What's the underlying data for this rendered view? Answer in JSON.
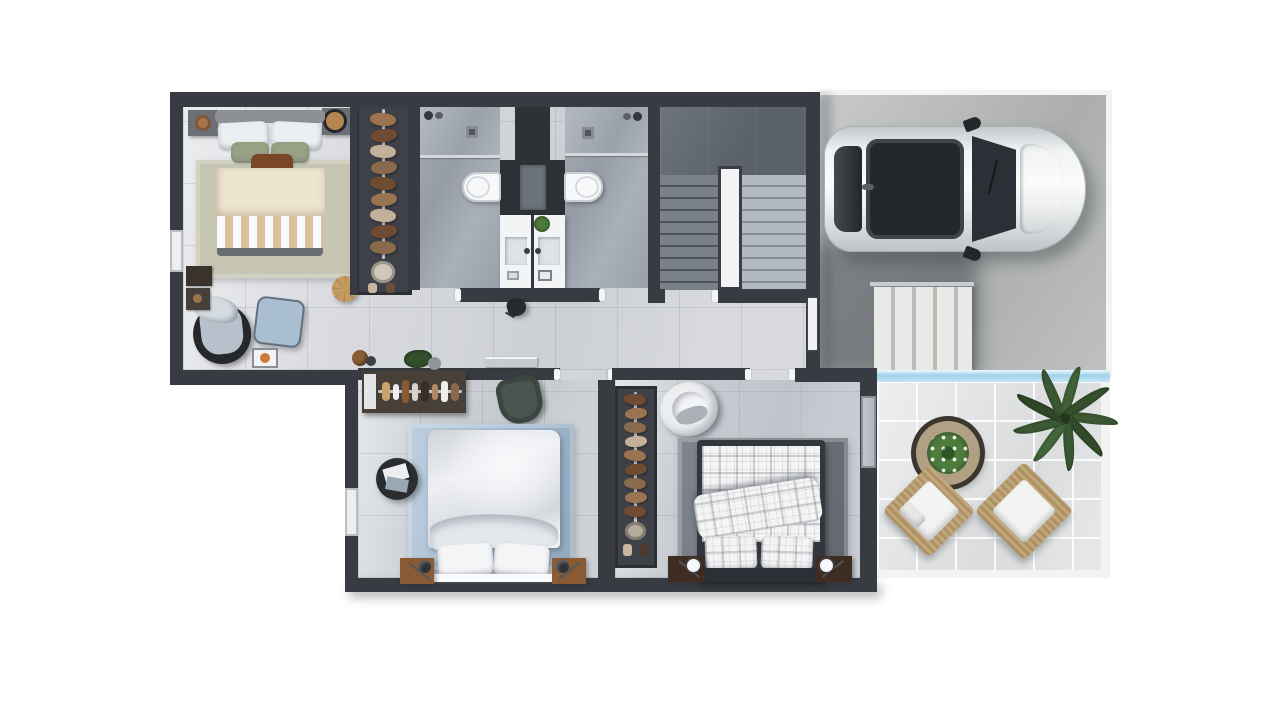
{
  "scene": {
    "type": "3d-floor-plan-render-top-down",
    "background": "#ffffff",
    "areas": [
      {
        "name": "bedroom-top-left",
        "objects": [
          "double-bed",
          "beige-duvet",
          "striped-runner",
          "sage-pillows",
          "rust-accent-pillow",
          "headboard",
          "nightstand-left",
          "nightstand-right",
          "sage-area-rug",
          "armchair",
          "blue-ottoman",
          "jute-pouf",
          "decor-tray",
          "wall-decor-boxes",
          "window"
        ]
      },
      {
        "name": "walk-in-closet-top",
        "objects": [
          "clothes-rail",
          "hanging-clothes",
          "shoes",
          "laundry-basket",
          "potted-plant"
        ]
      },
      {
        "name": "bathroom-left",
        "objects": [
          "walk-in-shower",
          "shower-drain",
          "shower-fixtures",
          "wall-hung-toilet",
          "vanity-sink",
          "faucet",
          "vanity-plant"
        ]
      },
      {
        "name": "bathroom-right",
        "objects": [
          "walk-in-shower",
          "shower-drain",
          "shower-fixtures",
          "wall-hung-toilet",
          "vanity-sink",
          "faucet"
        ]
      },
      {
        "name": "staircase",
        "objects": [
          "upper-landing",
          "down-flight",
          "up-flight",
          "white-center-wall"
        ]
      },
      {
        "name": "hallway",
        "objects": [
          "stool",
          "clay-pot",
          "potted-plant",
          "front-door"
        ]
      },
      {
        "name": "bedroom-bottom-left",
        "objects": [
          "double-bed-white",
          "white-pillows",
          "blue-area-rug",
          "wood-nightstand-left",
          "wood-nightstand-right",
          "dark-table-lamps",
          "round-side-table",
          "magazines",
          "wall-desk",
          "desk-chair",
          "cosmetics-dresser",
          "window"
        ]
      },
      {
        "name": "bedroom-bottom-middle",
        "objects": [
          "double-bed-plaid",
          "plaid-pillows",
          "plaid-throw",
          "dark-area-rug",
          "wardrobe",
          "hanging-clothes",
          "shoes",
          "white-armchair",
          "dark-nightstand-left",
          "dark-nightstand-right",
          "sphere-lamps",
          "sliding-glass-door"
        ]
      },
      {
        "name": "garage-driveway",
        "objects": [
          "white-car",
          "panoramic-roof",
          "windshield",
          "side-mirrors",
          "exterior-steps",
          "cast-shadow"
        ]
      },
      {
        "name": "patio",
        "objects": [
          "pool-edge-water-strip",
          "tile-paving",
          "wicker-armchair-left",
          "wicker-armchair-right",
          "round-coffee-table",
          "table-plant",
          "palm-plant",
          "white-border-walkway"
        ]
      }
    ]
  },
  "colors": {
    "wall": "#383c42",
    "wallDark": "#2e3237",
    "floorMain": "#d8dade",
    "floorBed2": "#ced2d7",
    "floorBed3": "#c9cdd3",
    "floorBath": "#9aa1ab",
    "showerFloor": "#adb3bb",
    "stairLanding": "#5a616b",
    "stairDark": "#79808a",
    "stairTreadDark": "#4d545e",
    "stairLight": "#b3b9c1",
    "stairTreadLight": "#858c96",
    "stairWall": "#f2f3f4",
    "driveway": "#b6b9b8",
    "steps": "#e9e9e7",
    "stepTread": "#bcbcb9",
    "pool": "#9fd2ea",
    "patio": "#e2e3e5",
    "patioEdge": "#f3f3f1",
    "rug1": "#c6c5b1",
    "rug2": "#a7bed3",
    "rug3": "#70767e",
    "bedBeige": "#eee5d1",
    "bedStripeTan": "#d9bf9e",
    "pillowSage": "#99a184",
    "pillowRust": "#7b4527",
    "headboard1": "#8d9094",
    "duvetWhite": "#eef0f3",
    "plaidBase": "#f4f4f5",
    "frameDark": "#33373d",
    "woodWarm": "#8a5a35",
    "woodDark": "#3f2d22",
    "lampWhite": "#f6f7f8",
    "tableBlack": "#2b2d30",
    "deskSilver": "#c7cbcf",
    "deskChair": "#49544f",
    "whiteChair": "#eceef0",
    "armchairBase": "#25282b",
    "armchairCushion": "#b6c1cc",
    "ottoman": "#a9bed1",
    "jute": "#c59b60",
    "wardrobe": "#3e4248",
    "rail": "#c3c7cb",
    "clothA": "#9a7350",
    "clothB": "#6f4b31",
    "clothC": "#c2b09a",
    "clothD": "#8a6a4c",
    "wicker": "#c2a77a",
    "cushion": "#f3f3f2",
    "palm": "#3c5a33",
    "plant": "#4e7c3c",
    "pot": "#8a5d36",
    "carBody": "#eef0f1",
    "carGlass": "#2b3036",
    "vanity": "#f2f4f5",
    "sink": "#dde2e6",
    "toilet": "#f7f8f9",
    "glassDoor": "#c3cad1"
  }
}
